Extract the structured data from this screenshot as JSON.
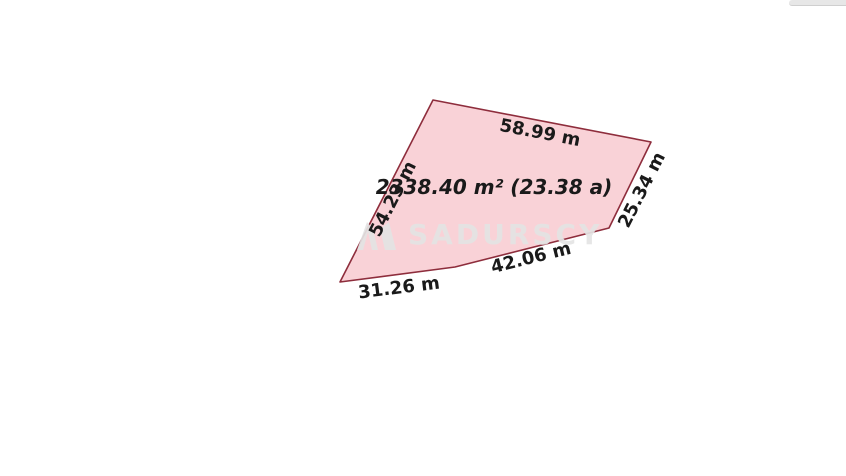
{
  "page": {
    "background_color": "#ffffff"
  },
  "top_right_artifact": {
    "color": "#e7e7e7"
  },
  "parcel": {
    "fill_color": "#f9d2d7",
    "stroke_color": "#8e2d3c",
    "area_label": "2338.40 m² (23.38 a)",
    "sides": [
      {
        "position": "top",
        "label": "58.99 m"
      },
      {
        "position": "right",
        "label": "25.34 m"
      },
      {
        "position": "bottom-right",
        "label": "42.06 m"
      },
      {
        "position": "bottom-left",
        "label": "31.26 m"
      },
      {
        "position": "left",
        "label": "54.23 m"
      }
    ]
  },
  "watermark": {
    "text": "SADURSCY",
    "color": "#e4e4e4"
  }
}
